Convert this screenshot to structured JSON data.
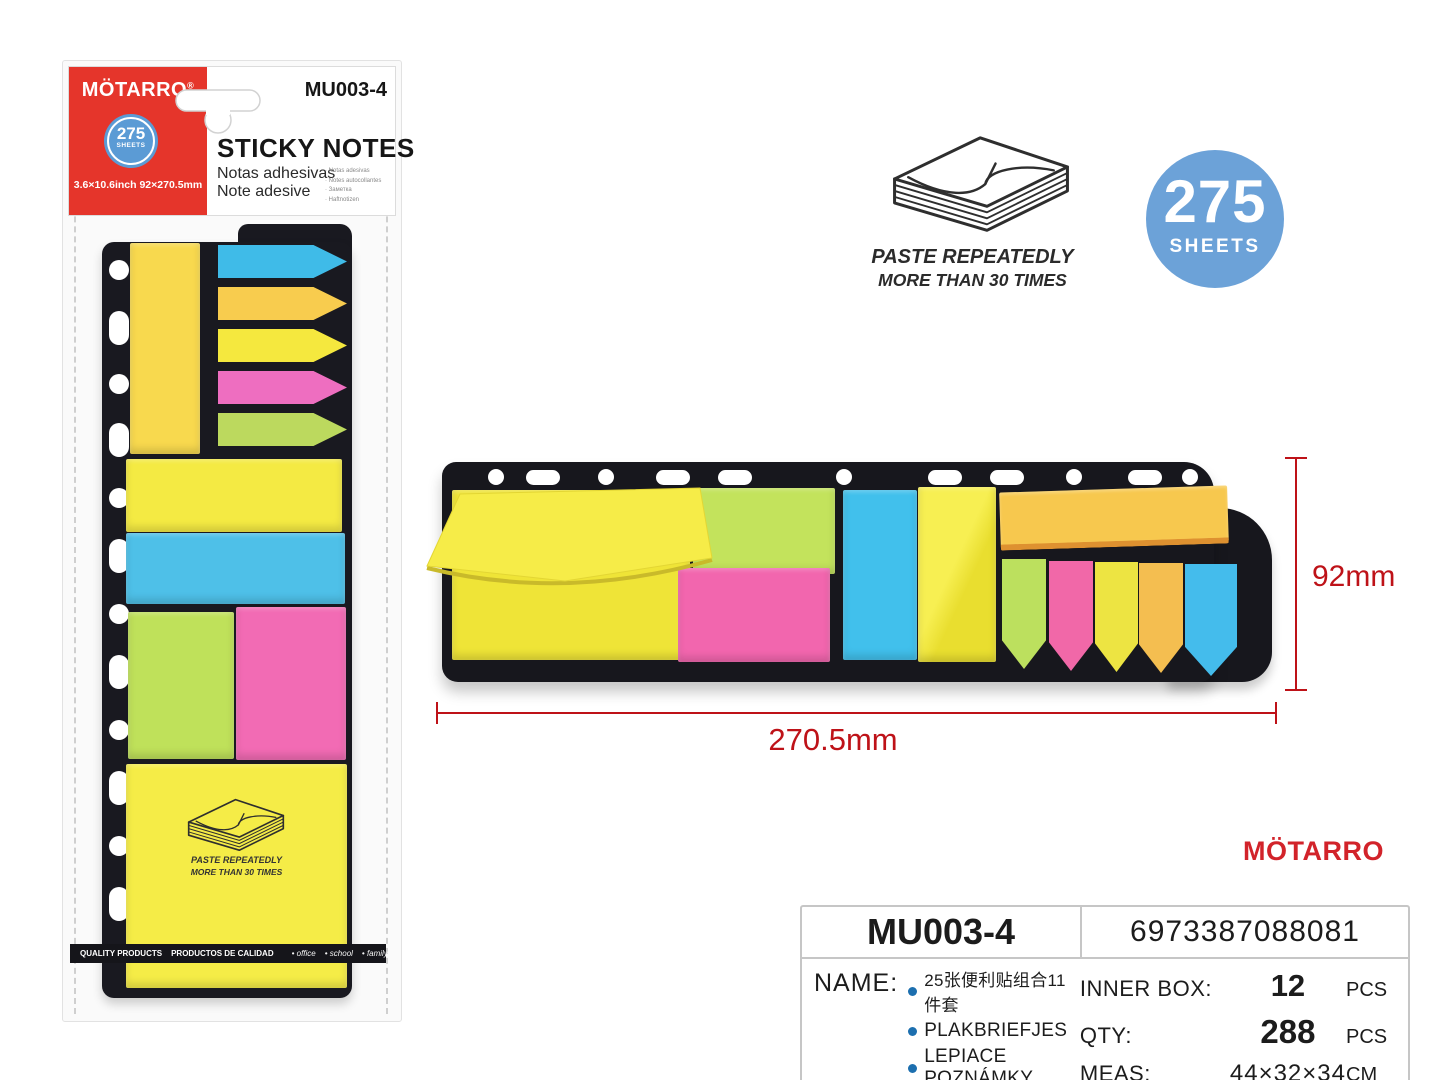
{
  "common": {
    "brand": "MÖTARRO",
    "sheets_count": "275",
    "sheets_unit": "SHEETS",
    "paste_line1": "PASTE REPEATEDLY",
    "paste_line2": "MORE THAN 30 TIMES"
  },
  "package": {
    "reg_mark": "®",
    "model": "MU003-4",
    "size_text": "3.6×10.6inch  92×270.5mm",
    "title": "STICKY NOTES",
    "subtitle_es": "Notas adhesivas",
    "subtitle_it": "Note adesive",
    "lang_list": [
      "· Notas adesivas",
      "· Notes autocollantes",
      "· Заметка",
      "· Haftnotizen"
    ],
    "footer_left1": "QUALITY PRODUCTS",
    "footer_left2": "PRODUCTOS DE CALIDAD",
    "footer_tags": [
      "• office",
      "• school",
      "• family"
    ]
  },
  "hero": {
    "dim_height": "92mm",
    "dim_width": "270.5mm"
  },
  "info": {
    "model": "MU003-4",
    "barcode": "6973387088081",
    "name_label": "NAME:",
    "names": [
      "25张便利贴组合11件套",
      "PLAKBRIEFJES",
      "LEPIACE POZNÁMKY"
    ],
    "specs": [
      {
        "label": "INNER BOX:",
        "value": "12",
        "unit": "PCS"
      },
      {
        "label": "QTY:",
        "value": "288",
        "unit": "PCS"
      },
      {
        "label": "MEAS:",
        "value": "44×32×34",
        "unit": "CM"
      }
    ]
  },
  "colors": {
    "header_red": "#E5352B",
    "badge_blue": "#6CA2D8",
    "dimension_red": "#BE1218",
    "bullet_blue": "#1C6FAF",
    "brand_red": "#D2232A",
    "panel_black": "#17171D",
    "pad_palette": {
      "yellow": "#F5EC47",
      "green": "#BFE15A",
      "pink": "#F266AE",
      "blue": "#41C0EC",
      "orange": "#F7C84E"
    }
  }
}
